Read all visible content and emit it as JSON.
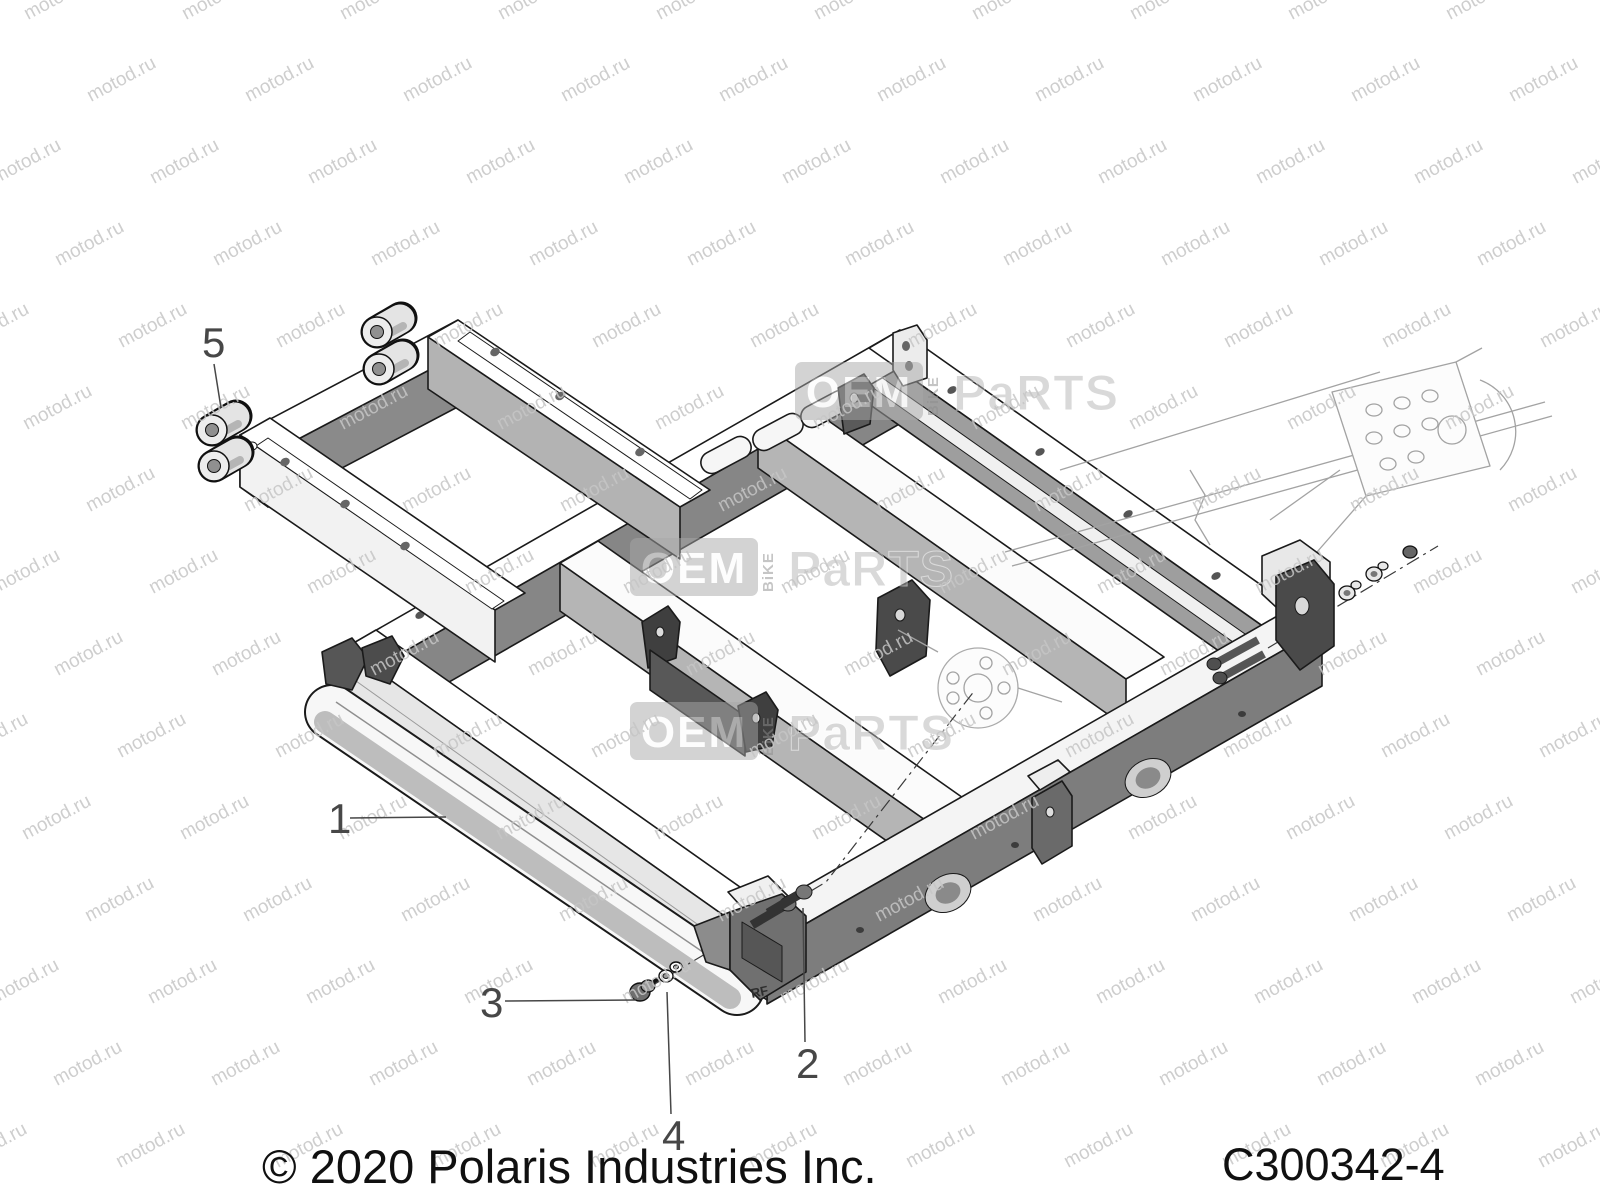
{
  "watermark": {
    "tile_text": "motod.ru",
    "brand_oem": "OEM",
    "brand_bike": "BiKE",
    "brand_parts": "PaRTS"
  },
  "footer": {
    "copyright": "© 2020 Polaris Industries Inc.",
    "drawing_code": "C300342-4"
  },
  "diagram": {
    "frame_marking": "RF",
    "callouts": [
      {
        "label": "1",
        "tx": 328,
        "ty": 833,
        "x1": 350,
        "y1": 818,
        "x2": 446,
        "y2": 817
      },
      {
        "label": "2",
        "tx": 796,
        "ty": 1078,
        "x1": 805,
        "y1": 1042,
        "x2": 803,
        "y2": 908
      },
      {
        "label": "3",
        "tx": 480,
        "ty": 1017,
        "x1": 505,
        "y1": 1001,
        "x2": 636,
        "y2": 1000
      },
      {
        "label": "4",
        "tx": 662,
        "ty": 1150,
        "x1": 671,
        "y1": 1114,
        "x2": 667,
        "y2": 992
      },
      {
        "label": "5",
        "tx": 202,
        "ty": 357,
        "x1": 214,
        "y1": 364,
        "x2": 221,
        "y2": 408
      }
    ]
  }
}
